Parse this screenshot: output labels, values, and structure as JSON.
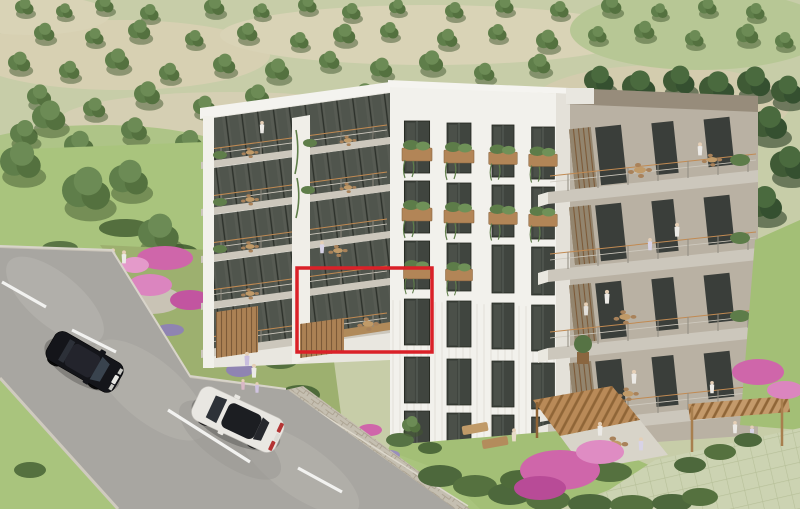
{
  "image": {
    "width": 800,
    "height": 509,
    "kind": "3d architectural rendering",
    "subject": "Aerial view of a modern five-storey apartment building with tiered balconies, landscaped gardens with pink bougainvillea, a road with a black car and a white car, and tree-covered hills behind. A red rectangle annotation highlights one balcony apartment unit."
  },
  "annotation": {
    "shape": "rectangle",
    "x": 297,
    "y": 268,
    "width": 135,
    "height": 84,
    "stroke_width": 3.5,
    "meaning": "highlighted apartment unit"
  },
  "scene": {
    "building_floors": 5,
    "cars": [
      {
        "body": "black"
      },
      {
        "body": "white"
      }
    ],
    "lane_dash_count": 4,
    "flowers": "pink bougainvillea",
    "highlight_color_name": "red"
  },
  "colors": {
    "annotation_red": "#da2128",
    "hill_base": "#c7cda8",
    "hill_tan": "#d7d0b2",
    "hill_green": "#b4c790",
    "tree_green": "#5f7e4a",
    "tree_dark": "#3f5a35",
    "lawn_green": "#a9c47d",
    "garden_green": "#9db06f",
    "road_gray": "#a8a6a1",
    "gravel": "#c9c3b8",
    "lane_marking": "#f2f2f0",
    "stone_wall": "#c5bfb1",
    "paver_grass": "#ccd3b2",
    "building_white": "#f2f1ec",
    "wing_white": "#e9e7e0",
    "balcony_slab": "#ccc7bc",
    "recess_shadow": "#575b53",
    "window_glass": "#40453f",
    "wood_accent": "#ab8154",
    "wood_fascia": "#b08a5a",
    "roof_parapet": "#978c7b",
    "wing_wall": "#b9b1a3",
    "flower_pink": "#cf66aa",
    "flower_pink_light": "#df8cc3",
    "hedge_green": "#4d683c",
    "car_black": "#14151a",
    "car_white": "#e9e7e2"
  }
}
